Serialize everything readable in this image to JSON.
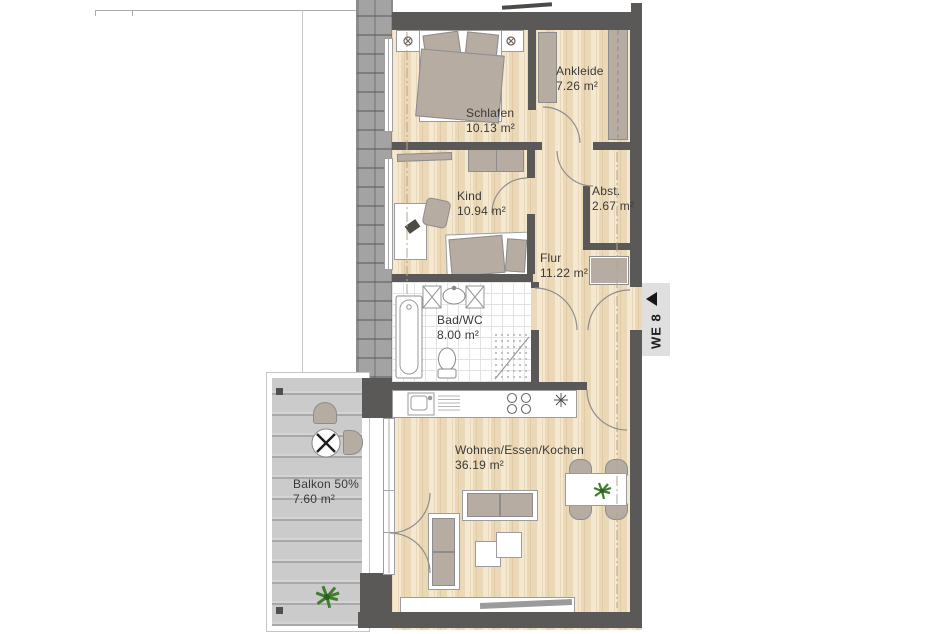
{
  "unit": {
    "label": "WE 8"
  },
  "rooms": [
    {
      "name": "Schlafen",
      "area": "10.13 m²"
    },
    {
      "name": "Ankleide",
      "area": "7.26 m²"
    },
    {
      "name": "Kind",
      "area": "10.94 m²"
    },
    {
      "name": "Abst.",
      "area": "2.67 m²"
    },
    {
      "name": "Flur",
      "area": "11.22 m²"
    },
    {
      "name": "Bad/WC",
      "area": "8.00 m²"
    },
    {
      "name": "Wohnen/Essen/Kochen",
      "area": "36.19 m²"
    },
    {
      "name": "Balkon 50%",
      "area": "7.60 m²"
    }
  ],
  "colors": {
    "wall": "#5a5958",
    "wood": "#f2e2c4",
    "furniture": "#b6aca2",
    "balcony": "#cbcbcb",
    "hatch": "#a3a3a3",
    "plant": "#3f7d2f",
    "unit-bg": "#dfdfdf",
    "label": "#3a3a38"
  }
}
